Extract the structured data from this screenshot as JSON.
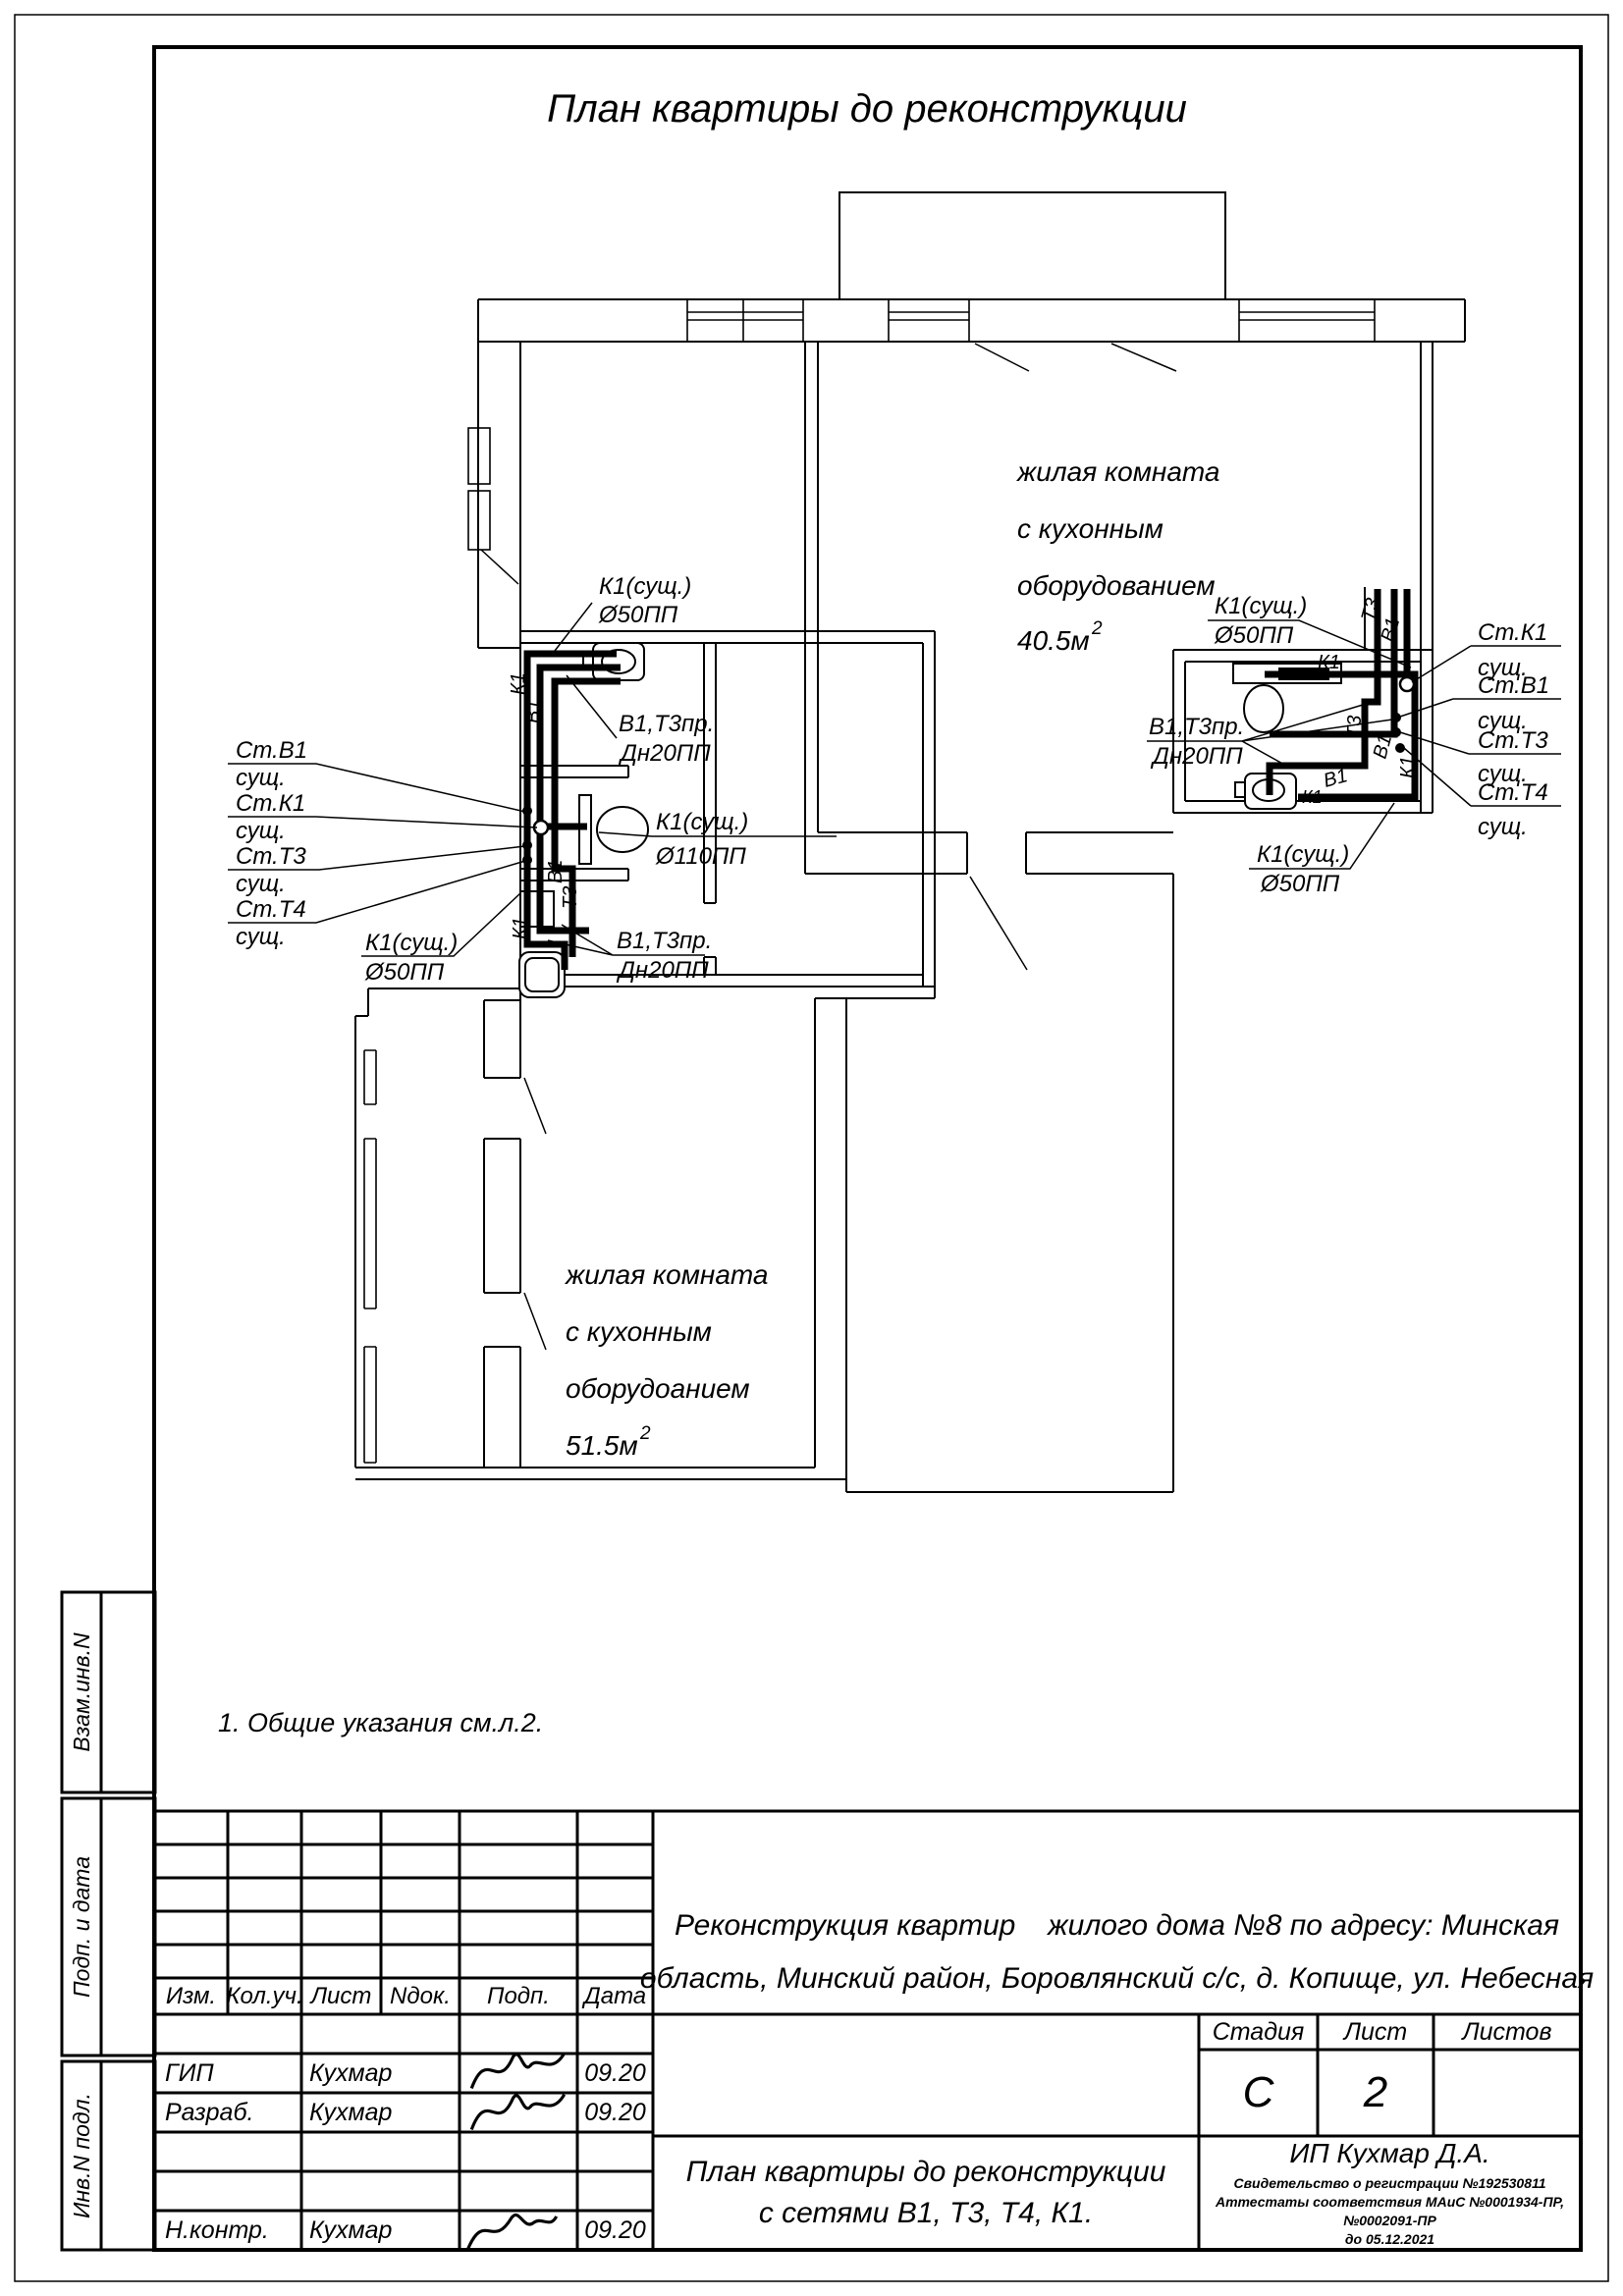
{
  "page_title": "План квартиры до реконструкции",
  "general_note": "1. Общие указания см.л.2.",
  "rooms": {
    "upper": {
      "l1": "жилая комната",
      "l2": "с кухонным",
      "l3": "оборудованием",
      "area": "40.5м",
      "sup": "2"
    },
    "lower": {
      "l1": "жилая комната",
      "l2": "с кухонным",
      "l3": "оборудоанием",
      "area": "51.5м",
      "sup": "2"
    }
  },
  "pipe_labels": {
    "left_top_k1": {
      "l1": "К1(сущ.)",
      "l2": "Ø50ПП"
    },
    "left_v1t3_top": {
      "l1": "В1,Т3пр.",
      "l2": "Дн20ПП"
    },
    "left_k1_110": {
      "l1": "К1(сущ.)",
      "l2": "Ø110ПП"
    },
    "left_bottom_k1": {
      "l1": "К1(сущ.)",
      "l2": "Ø50ПП"
    },
    "left_v1t3_bottom": {
      "l1": "В1,Т3пр.",
      "l2": "Дн20ПП"
    },
    "right_top_k1": {
      "l1": "К1(сущ.)",
      "l2": "Ø50ПП"
    },
    "right_v1t3": {
      "l1": "В1,Т3пр.",
      "l2": "Дн20ПП"
    },
    "right_bottom_k1": {
      "l1": "К1(сущ.)",
      "l2": "Ø50ПП"
    }
  },
  "stacks_left": [
    {
      "n": "Ст.В1",
      "s": "сущ."
    },
    {
      "n": "Ст.К1",
      "s": "сущ."
    },
    {
      "n": "Ст.Т3",
      "s": "сущ."
    },
    {
      "n": "Ст.Т4",
      "s": "сущ."
    }
  ],
  "stacks_right": [
    {
      "n": "Ст.К1",
      "s": "сущ."
    },
    {
      "n": "Ст.В1",
      "s": "сущ."
    },
    {
      "n": "Ст.Т3",
      "s": "сущ."
    },
    {
      "n": "Ст.Т4",
      "s": "сущ."
    }
  ],
  "tags": {
    "k1": "К1",
    "v1": "В1",
    "t3": "Т3"
  },
  "sidebar": {
    "box1": "Взам.инв.N",
    "box2": "Подп. и дата",
    "box3": "Инв.N подл."
  },
  "title_block": {
    "columns": [
      "Изм.",
      "Кол.уч.",
      "Лист",
      "Nдок.",
      "Подп.",
      "Дата"
    ],
    "rows": [
      {
        "role": "ГИП",
        "name": "Кухмар",
        "date": "09.20"
      },
      {
        "role": "Разраб.",
        "name": "Кухмар",
        "date": "09.20"
      },
      {
        "role": "Н.контр.",
        "name": "Кухмар",
        "date": "09.20"
      }
    ],
    "project": {
      "line1_left": "Реконструкция квартир",
      "line1_right": "жилого дома №8 по адресу: Минская",
      "line2": "область, Минский район, Боровлянский с/с, д. Копище, ул. Небесная"
    },
    "stage_label": "Стадия",
    "sheet_label": "Лист",
    "sheets_label": "Листов",
    "stage": "С",
    "sheet": "2",
    "sheets": "",
    "drawing_title": {
      "line1": "План квартиры до реконструкции",
      "line2": "с сетями В1, Т3, Т4, К1."
    },
    "company": {
      "name": "ИП Кухмар Д.А.",
      "cert1": "Свидетельство о регистрации №192530811",
      "cert2": "Аттестаты соответствия МАиС №0001934-ПР, №0002091-ПР",
      "cert3": "до 05.12.2021"
    }
  }
}
